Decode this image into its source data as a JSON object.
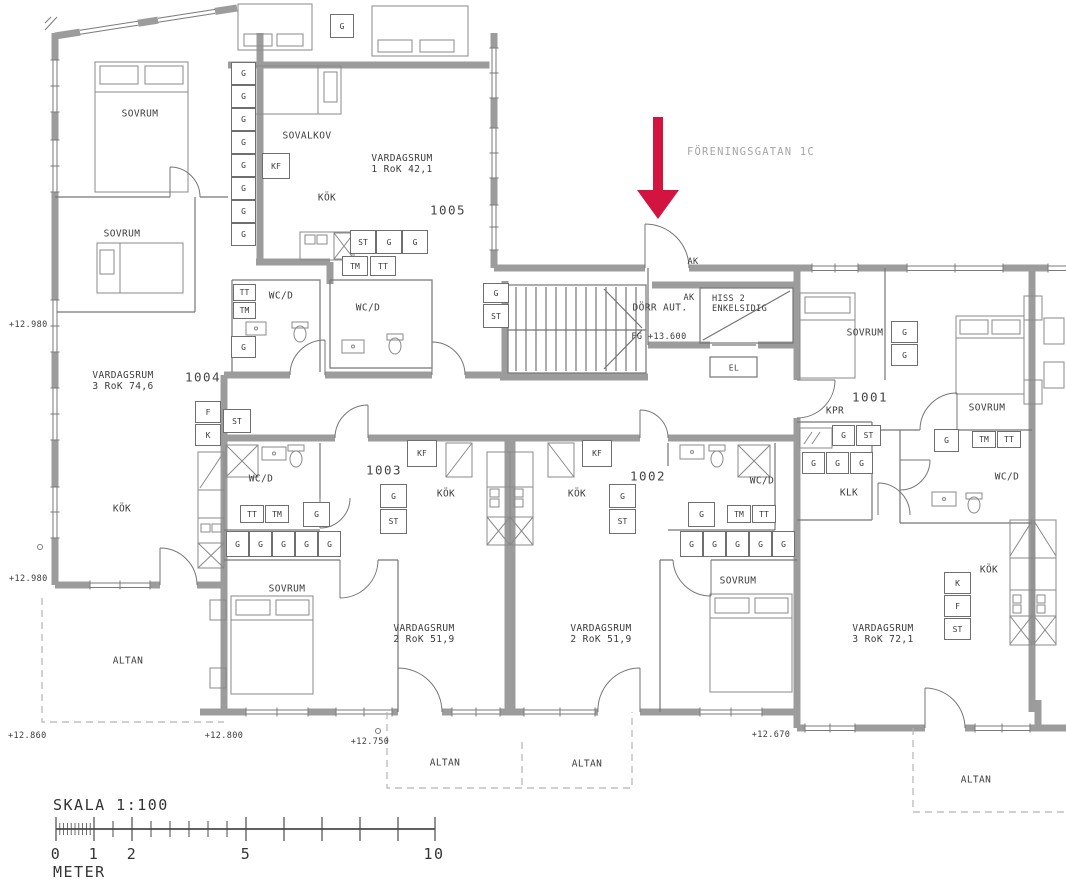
{
  "street_label": "FÖRENINGSGATAN 1C",
  "apartments": {
    "a1005": {
      "number": "1005",
      "name": "VARDAGSRUM",
      "size": "1 RoK 42,1"
    },
    "a1004": {
      "number": "1004",
      "name": "VARDAGSRUM",
      "size": "3 RoK 74,6"
    },
    "a1003": {
      "number": "1003",
      "name": "VARDAGSRUM",
      "size": "2 RoK 51,9"
    },
    "a1002": {
      "number": "1002",
      "name": "VARDAGSRUM",
      "size": "2 RoK 51,9"
    },
    "a1001": {
      "number": "1001",
      "name": "VARDAGSRUM",
      "size": "3 RoK 72,1"
    }
  },
  "rooms": {
    "sovrum": "SOVRUM",
    "sovalkov": "SOVALKOV",
    "kok": "KÖK",
    "wcd": "WC/D",
    "altan": "ALTAN",
    "kpr": "KPR",
    "klk": "KLK"
  },
  "fixtures": {
    "g": "G",
    "st": "ST",
    "tm": "TM",
    "tt": "TT",
    "kf": "KF",
    "f": "F",
    "k": "K"
  },
  "entrance": {
    "door": "DÖRR AUT.",
    "floor_level": "FG +13.600",
    "ak": "AK",
    "hiss_line1": "HISS 2",
    "hiss_line2": "ENKELSIDIG",
    "el": "EL"
  },
  "elevations": {
    "left_upper": "+12.980",
    "left_lower": "+12.980",
    "bottom_left": "+12.860",
    "bottom_1004": "+12.800",
    "bottom_1003": "+12.750",
    "bottom_1001": "+12.670"
  },
  "scale_bar": {
    "title": "SKALA 1:100",
    "unit": "METER",
    "ticks": [
      "0",
      "1",
      "2",
      "5",
      "10"
    ]
  },
  "colors": {
    "wall": "#9c9c9c",
    "line": "#6f6f6f",
    "arrow": "#d41440"
  }
}
